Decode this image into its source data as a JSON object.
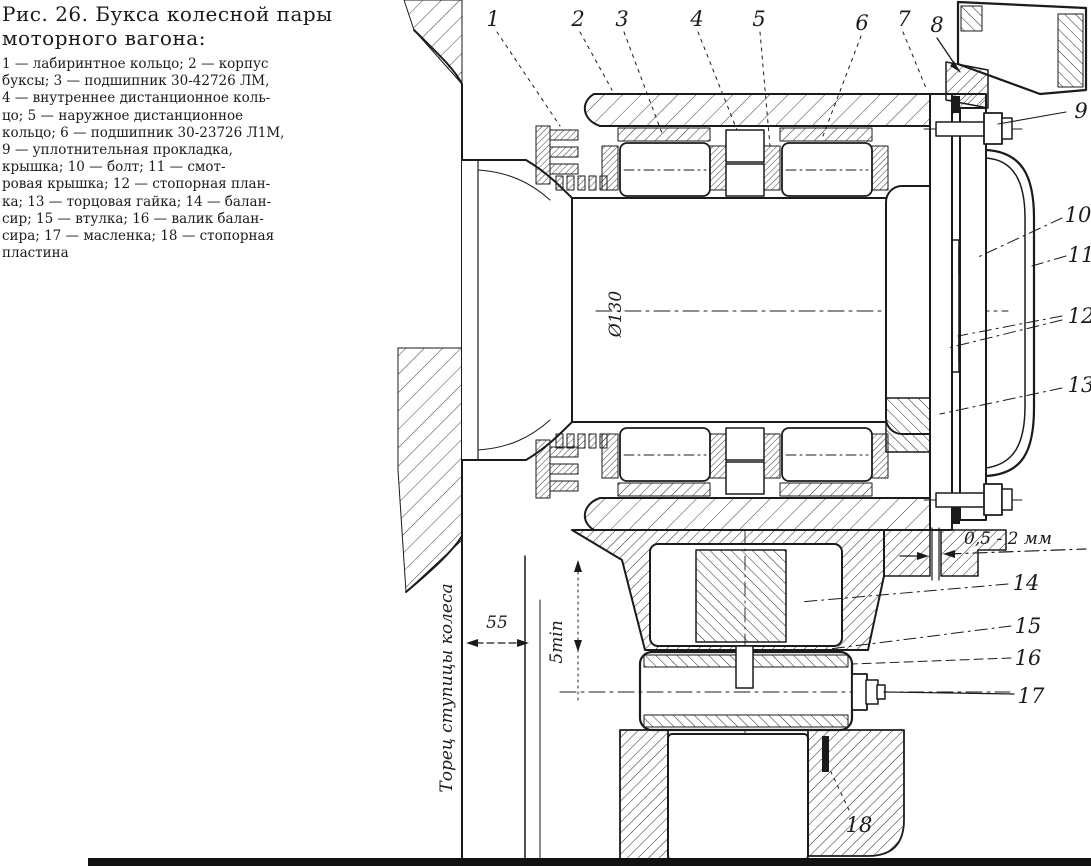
{
  "colors": {
    "ink": "#1b1b1b",
    "paper": "#ffffff"
  },
  "figure_caption": {
    "title_line1": "Рис. 26. Букса колесной пары",
    "title_line2": "моторного вагона:",
    "lines": [
      "1 — лабиринтное кольцо; 2 — корпус",
      "буксы; 3 — подшипник 30-42726 ЛМ,",
      "4 — внутреннее дистанционное коль-",
      "цо; 5 — наружное дистанционное",
      "кольцо; 6 — подшипник 30-23726 Л1М,",
      "9 — уплотнительная прокладка,",
      "крышка; 10 — болт; 11 — смот-",
      "ровая крышка; 12 — стопорная план-",
      "ка; 13 — торцовая гайка; 14 — балан-",
      "сир; 15 — втулка; 16 — валик балан-",
      "сира; 17 — масленка; 18 — стопорная",
      "пластина"
    ]
  },
  "callouts": [
    "1",
    "2",
    "3",
    "4",
    "5",
    "6",
    "7",
    "8",
    "9",
    "10",
    "11",
    "12",
    "13",
    "14",
    "15",
    "16",
    "17",
    "18"
  ],
  "dimensions": {
    "diameter": "Ø130",
    "gap": "0,5 - 2 мм",
    "hub_offset": "55",
    "min_clearance": "5min",
    "hub_face": "Торец ступицы колеса"
  }
}
